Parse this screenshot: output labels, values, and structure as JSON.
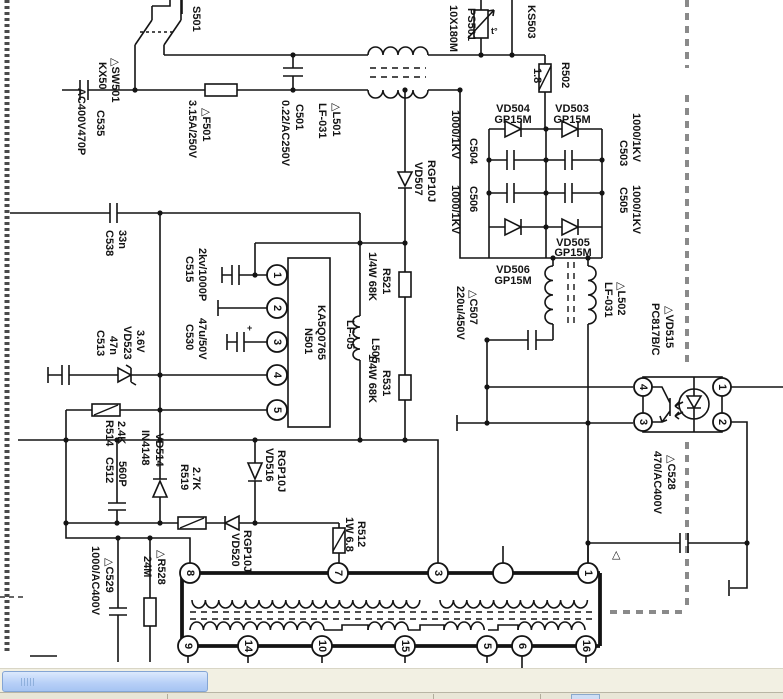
{
  "schematic": {
    "components": {
      "s501": {
        "name": "S501"
      },
      "sw501": {
        "name": "△SW501",
        "value": "KX50"
      },
      "c535": {
        "name": "C535",
        "value": "AC400V470P"
      },
      "f501": {
        "name": "△F501",
        "value": "3.15A/250V"
      },
      "c501": {
        "name": "C501",
        "value": "0.22/AC250V"
      },
      "l501": {
        "name": "△L501",
        "value": "LF-031"
      },
      "ps501": {
        "name": "PS501",
        "value": "10X180M"
      },
      "ks503": {
        "name": "KS503"
      },
      "r502": {
        "name": "R502",
        "value": "1.8"
      },
      "vd504": {
        "name": "VD504",
        "value": "GP15M"
      },
      "vd503": {
        "name": "VD503",
        "value": "GP15M"
      },
      "vd506": {
        "name": "VD506",
        "value": "GP15M"
      },
      "vd505": {
        "name": "VD505",
        "value": "GP15M"
      },
      "c504": {
        "name": "C504",
        "value": "1000/1KV"
      },
      "c506": {
        "name": "C506",
        "value": "1000/1KV"
      },
      "c503": {
        "name": "C503",
        "value": "1000/1KV"
      },
      "c505": {
        "name": "C505",
        "value": "1000/1KV"
      },
      "l502": {
        "name": "△L502",
        "value": "LF-031"
      },
      "c507": {
        "name": "△C507",
        "value": "220u/450V"
      },
      "vd507": {
        "name": "VD507",
        "value": "RGP10J"
      },
      "c538": {
        "name": "C538",
        "value": "33n"
      },
      "c515": {
        "name": "C515",
        "value": "2kv/1000P"
      },
      "c530": {
        "name": "C530",
        "value": "47u/50V"
      },
      "n501": {
        "name": "N501",
        "value": "KA5Q0765"
      },
      "l505": {
        "name": "L505",
        "value": "LF-05"
      },
      "r521": {
        "name": "R521",
        "value": "1/4W 68K"
      },
      "r531": {
        "name": "R531",
        "value": "1/4W 68K"
      },
      "vd523": {
        "name": "VD523",
        "value": "3.6V"
      },
      "c513": {
        "name": "C513",
        "value": "47n"
      },
      "r514": {
        "name": "R514",
        "value": "2.4K"
      },
      "vd514": {
        "name": "VD514",
        "value": "IN4148"
      },
      "c512": {
        "name": "C512",
        "value": "560P"
      },
      "r519": {
        "name": "R519",
        "value": "2.7K"
      },
      "vd516": {
        "name": "VD516",
        "value": "RGP10J"
      },
      "vd520": {
        "name": "VD520",
        "value": "RGP10J"
      },
      "r512": {
        "name": "R512",
        "value": "1W 6.8"
      },
      "c529": {
        "name": "△C529",
        "value": "1000/AC400V"
      },
      "r528": {
        "name": "△R528",
        "value": "24M"
      },
      "vd515": {
        "name": "△VD515",
        "value": "PC817B/C"
      },
      "c528": {
        "name": "△C528",
        "value": "470/AC400V"
      }
    },
    "ic_pins": [
      "1",
      "2",
      "3",
      "4",
      "5"
    ],
    "opto_pins": {
      "p4": "4",
      "p3": "3",
      "p1": "1",
      "p2": "2"
    },
    "transformer": {
      "top_pins": [
        "8",
        "7",
        "3",
        "",
        "1"
      ],
      "bottom_pins": [
        "9",
        "14",
        "10",
        "15",
        "5",
        "6",
        "16"
      ]
    },
    "marks": {
      "warning": "△",
      "thermal": "t°",
      "polarity": "+"
    }
  }
}
